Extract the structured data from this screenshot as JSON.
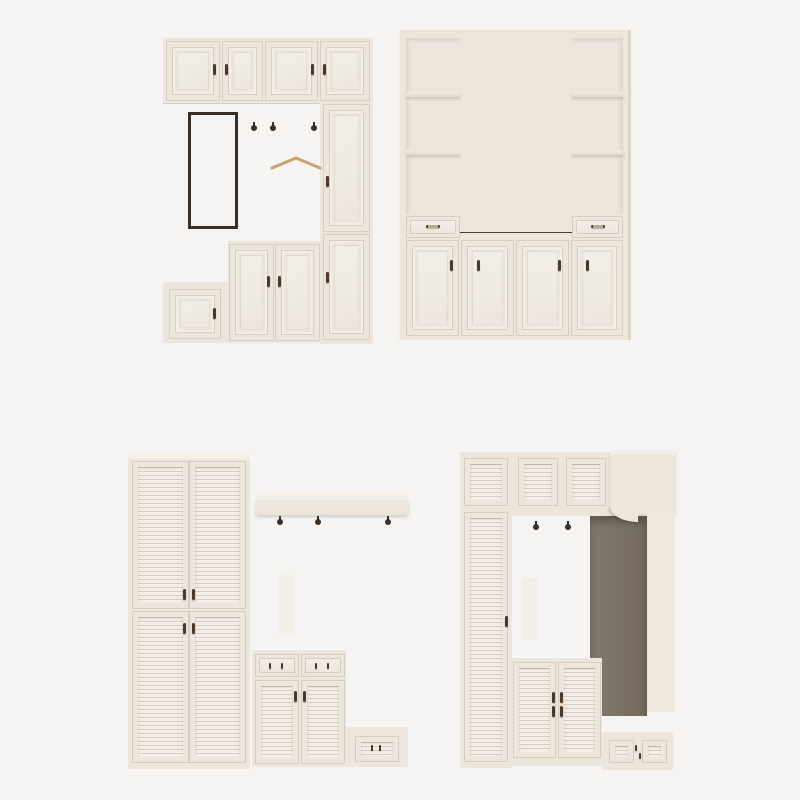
{
  "scene": {
    "description": "Product renders of four cream-white hallway / mudroom storage cabinet units on a plain light studio background",
    "units": [
      {
        "position": "top-left",
        "type": "hallway cabinet with mirror panel, coat hooks, bench and panel doors",
        "props": [
          "blue-grey fedora hat",
          "wooden hanger",
          "orange crossbody bag",
          "orange backpack",
          "brown suede tote bag",
          "pair of dark shoes"
        ]
      },
      {
        "position": "top-right",
        "type": "bookcase wall unit with dark display niche, open shelves, two drawers and four panel doors",
        "props": [
          "framed picture",
          "row of books",
          "small dark dish",
          "potted succulent",
          "two framed pictures",
          "white ceramic vases",
          "round white vase",
          "green potted plant",
          "stack of books"
        ]
      },
      {
        "position": "bottom-left",
        "type": "louvered wardrobe with coat shelf, hooks, shoe cabinet and step bench",
        "props": [
          "three potted succulents",
          "white flower bouquet",
          "dried silver bouquet ornament",
          "orange scarf",
          "brown shoulder bag",
          "black gallery collage frame",
          "green potted plants",
          "white candlestick",
          "white jug",
          "bird figurine",
          "grey bench cushion"
        ]
      },
      {
        "position": "bottom-right",
        "type": "louvered hall unit with open dark niche, wall shelf, hooks, shoe cabinet and step bench",
        "props": [
          "orange scarf",
          "brown shoulder bag",
          "black gallery collage frame",
          "green potted plant",
          "two bird figurines",
          "grey bench cushion"
        ]
      }
    ]
  },
  "palette": {
    "bg": "#f5f4f2",
    "cream": "#ece6dd",
    "cream_hi": "#f3efe8",
    "cream_sh": "#ddd3c6",
    "line": "#d6ccbf",
    "plinth": "#e2d9cc",
    "dark_frame": "#3a2f26",
    "mirror": "#766b5e",
    "mirror_top": "#474038",
    "niche": "#7e7467",
    "niche_top": "#40382f",
    "hook": "#3d2f24",
    "handle": "#4a382a",
    "brass": "#b9a98e",
    "orange": "#d2794a",
    "orange_dk": "#b5602f",
    "hat": "#90a6b0",
    "hat_dk": "#75909c",
    "tan": "#d2ad7c",
    "tote": "#8a7053",
    "tote_dk": "#6d573f",
    "brownbag": "#6f4a37",
    "brownbag_dk": "#55372a",
    "green": "#55903f",
    "green_dk": "#3e7030",
    "pot": "#f4f1ea",
    "cushion": "#b4ada2",
    "cushion_hi": "#c6bfb4",
    "white_back": "#f6f3ed",
    "collage": "#26211b",
    "paper": "#efeae1"
  }
}
